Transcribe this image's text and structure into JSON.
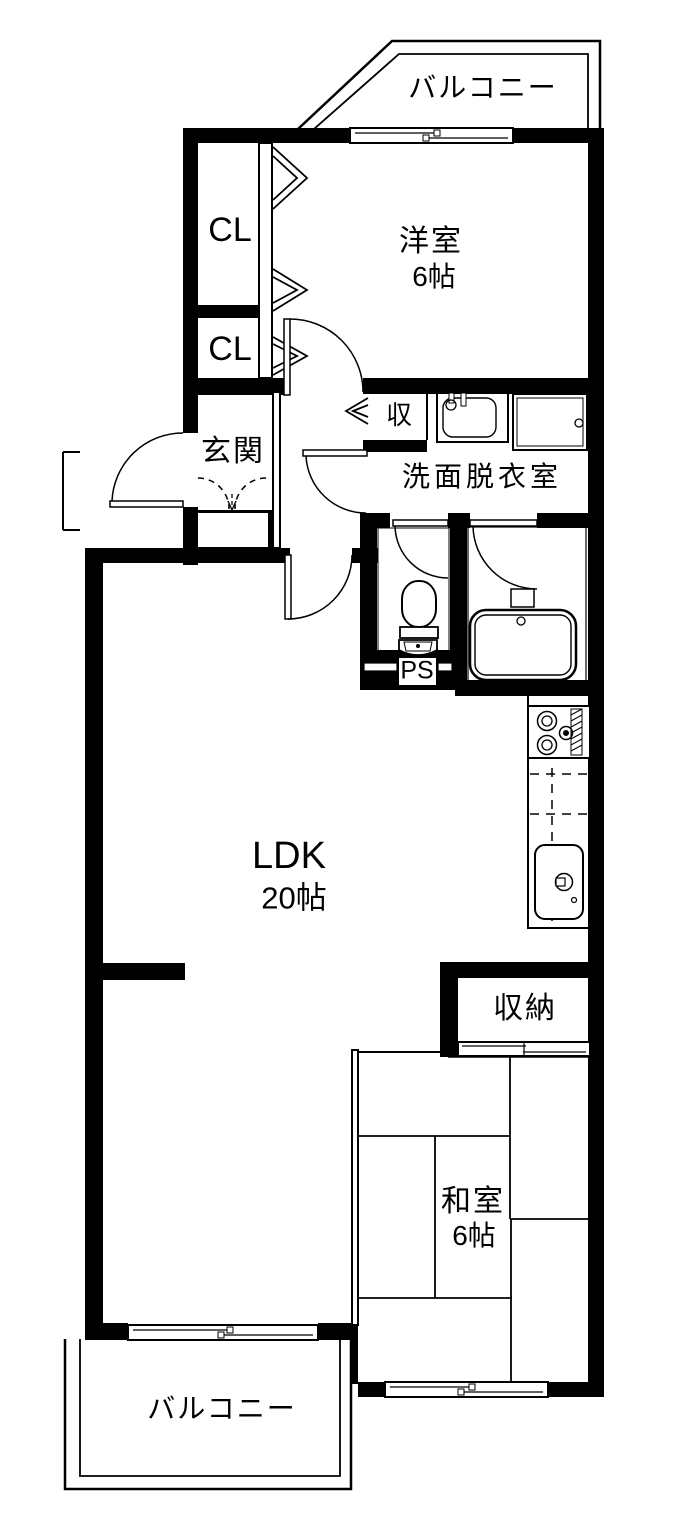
{
  "rooms": {
    "balcony_top": {
      "label": "バルコニー"
    },
    "western_room": {
      "label": "洋室",
      "size": "6帖"
    },
    "closet_upper": {
      "label": "CL"
    },
    "closet_lower": {
      "label": "CL"
    },
    "entrance": {
      "label": "玄関"
    },
    "hall_storage": {
      "label": "収"
    },
    "washroom": {
      "label": "洗面脱衣室"
    },
    "pipe_space": {
      "label": "PS"
    },
    "ldk": {
      "label": "LDK",
      "size": "20帖"
    },
    "storage": {
      "label": "収納"
    },
    "japanese_room": {
      "label": "和室",
      "size": "6帖"
    },
    "balcony_bottom": {
      "label": "バルコニー"
    }
  },
  "colors": {
    "line": "#000000",
    "background": "#ffffff"
  }
}
